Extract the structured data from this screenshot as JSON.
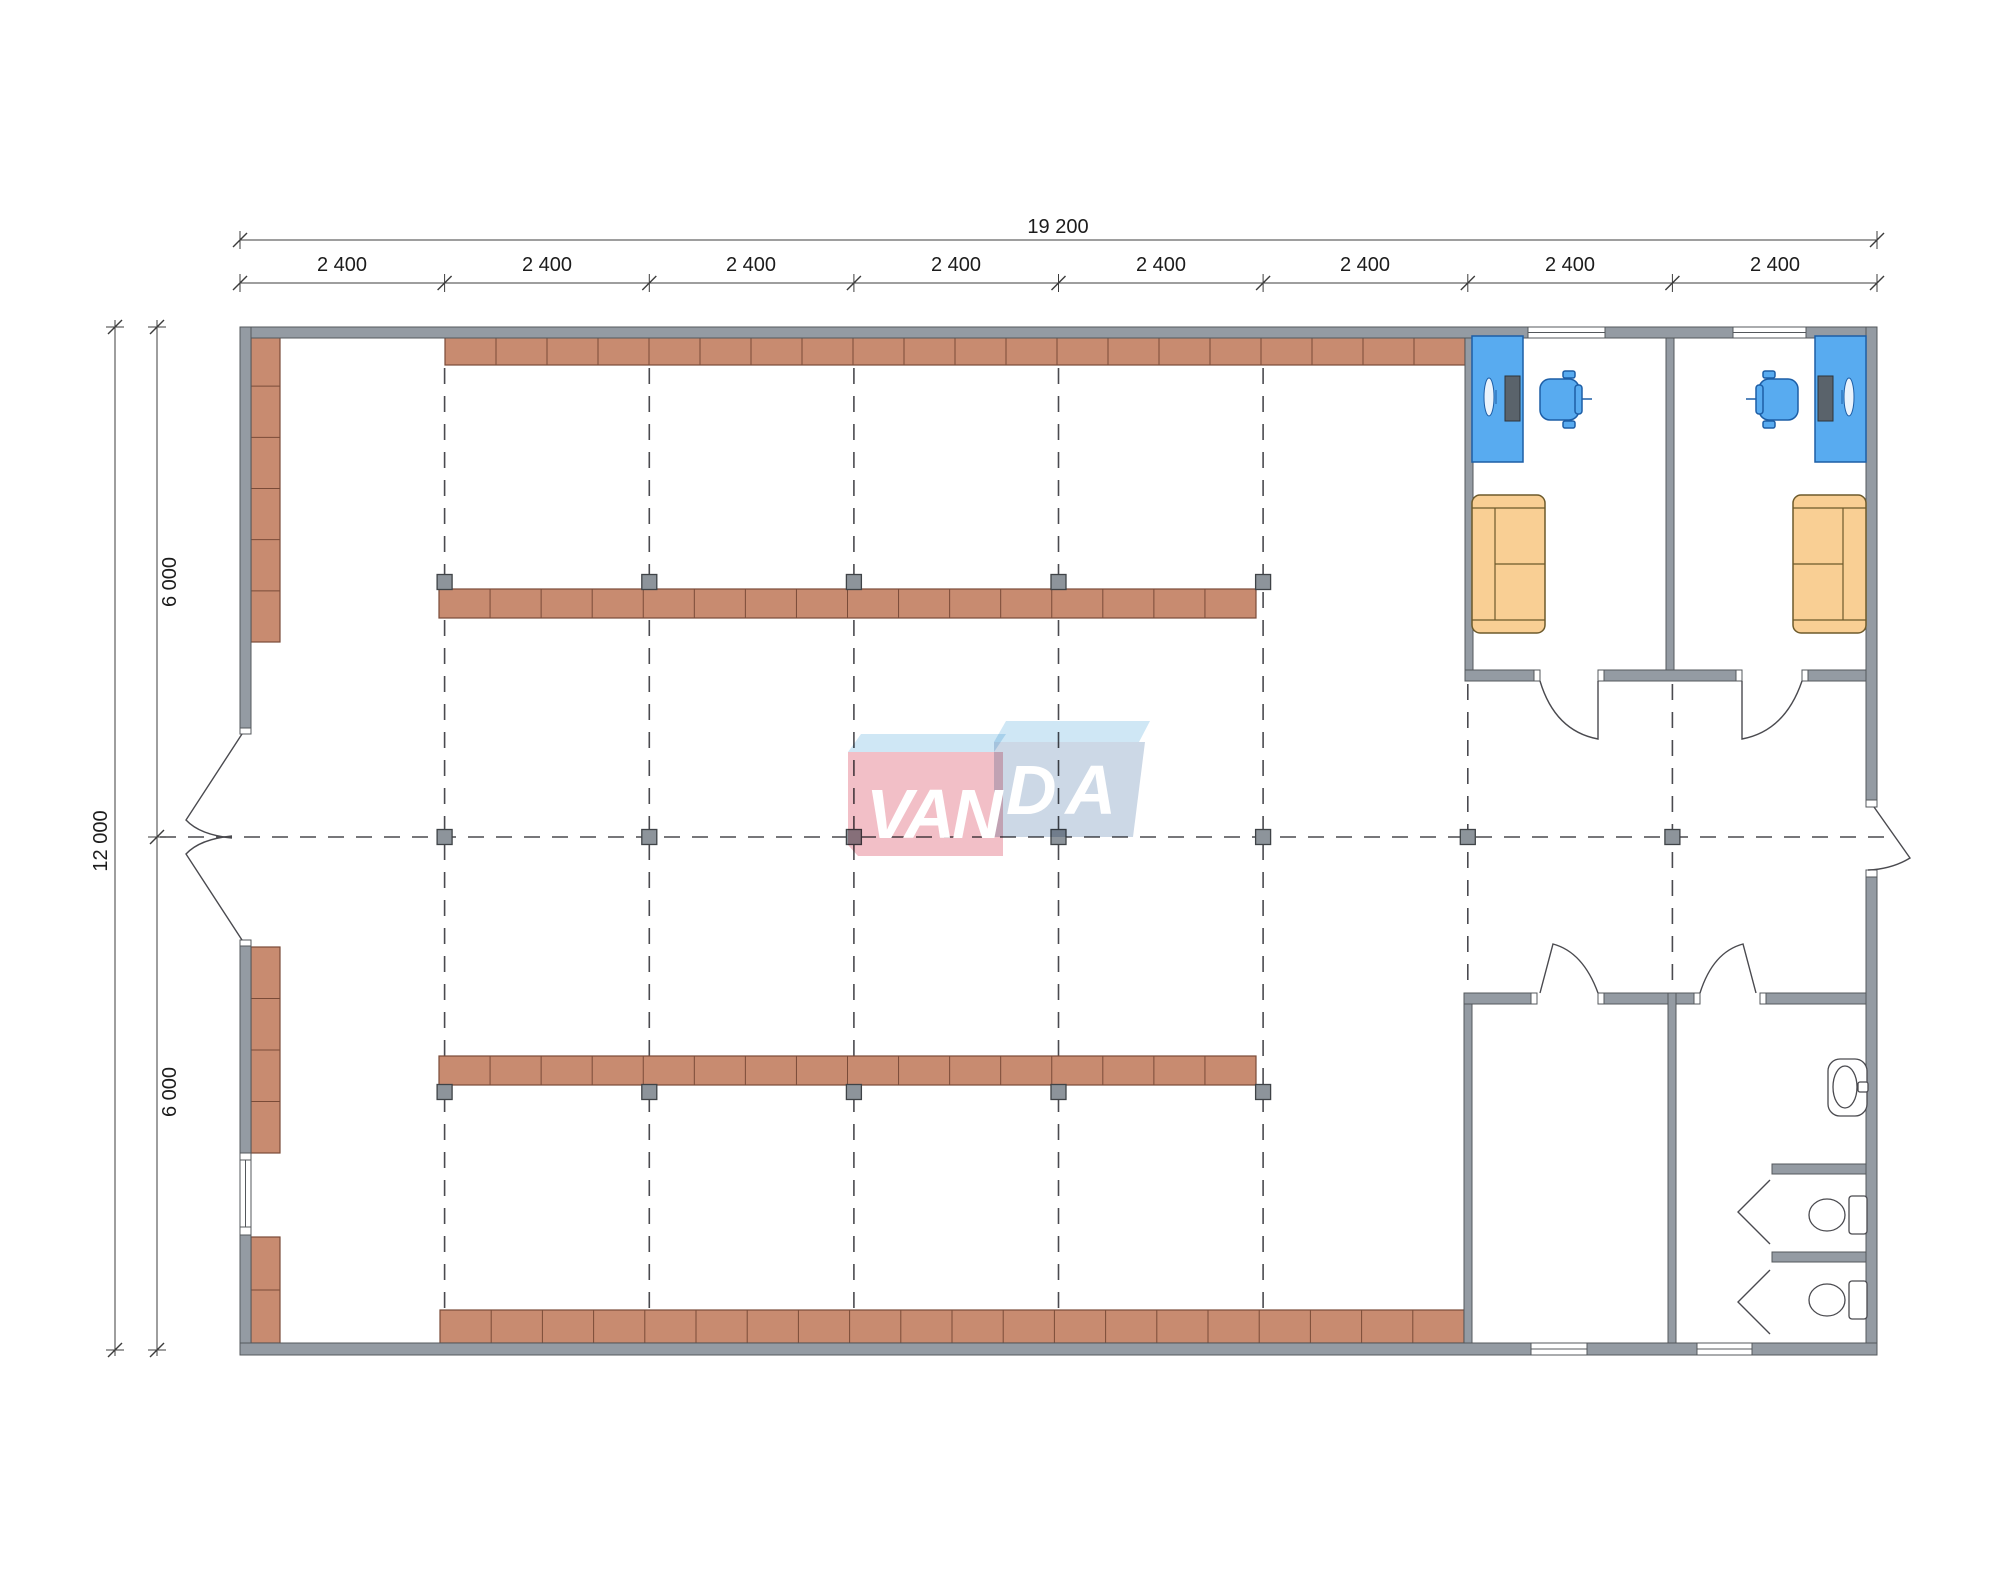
{
  "title": "VANDA modular building floor plan",
  "dimensions": {
    "top_total": "19 200",
    "top_segments": [
      "2 400",
      "2 400",
      "2 400",
      "2 400",
      "2 400",
      "2 400",
      "2 400",
      "2 400"
    ],
    "left_total": "12 000",
    "left_segments": [
      "6 000",
      "6 000"
    ]
  },
  "logo": {
    "part1": "VAN",
    "part2": "DA",
    "pink": "#f2bfc7",
    "blue": "#ccd8e6",
    "flap": "#cfe7f5"
  },
  "colors": {
    "wall_fill": "#949ba3",
    "wall_stroke": "#54585c",
    "shelf_fill": "#c88b70",
    "shelf_stroke": "#7a4b38",
    "column_fill": "#8d949b",
    "column_stroke": "#3f4347",
    "desk_blue": "#58abf0",
    "desk_stroke": "#1d5ea6",
    "sofa_fill": "#f9cf94",
    "sofa_stroke": "#6d5a2b",
    "grid_dash": "#4a4a4f",
    "dim_line": "#3c3c3c",
    "fixture_stroke": "#4a4a4f"
  },
  "plan": {
    "shelves": [
      {
        "x": 445,
        "y": 336,
        "w": 1020,
        "h": 29,
        "seg": 20,
        "dir": "h"
      },
      {
        "x": 439,
        "y": 589,
        "w": 817,
        "h": 29,
        "seg": 16,
        "dir": "h"
      },
      {
        "x": 439,
        "y": 1056,
        "w": 817,
        "h": 29,
        "seg": 16,
        "dir": "h"
      },
      {
        "x": 440,
        "y": 1310,
        "w": 1024,
        "h": 33,
        "seg": 20,
        "dir": "h"
      },
      {
        "x": 251,
        "y": 335,
        "w": 29,
        "h": 307,
        "seg": 6,
        "dir": "v"
      },
      {
        "x": 251,
        "y": 947,
        "w": 29,
        "h": 206,
        "seg": 4,
        "dir": "v"
      },
      {
        "x": 251,
        "y": 1237,
        "w": 29,
        "h": 106,
        "seg": 2,
        "dir": "v"
      }
    ],
    "squares": {
      "size": 15,
      "rows": [
        {
          "cy": 582,
          "xs": [
            444.6,
            649.3,
            853.9,
            1058.5,
            1263.1
          ]
        },
        {
          "cy": 1092,
          "xs": [
            444.6,
            649.3,
            853.9,
            1058.5,
            1263.1
          ]
        },
        {
          "cy": 837,
          "xs": [
            444.6,
            649.3,
            853.9,
            1058.5,
            1263.1,
            1467.8,
            1672.4
          ]
        }
      ]
    },
    "grid": {
      "vertical": [
        {
          "x": 444.6,
          "y1": 368,
          "y2": 1308
        },
        {
          "x": 649.3,
          "y1": 368,
          "y2": 1308
        },
        {
          "x": 853.9,
          "y1": 368,
          "y2": 1308
        },
        {
          "x": 1058.5,
          "y1": 368,
          "y2": 1308
        },
        {
          "x": 1263.1,
          "y1": 368,
          "y2": 1308
        },
        {
          "x": 1467.8,
          "y1": 684,
          "y2": 991
        },
        {
          "x": 1672.4,
          "y1": 684,
          "y2": 991
        }
      ],
      "horizontal": {
        "y": 837,
        "x1": 160,
        "x2": 1895
      }
    },
    "ticks": {
      "top_total": {
        "y": 240,
        "xs": [
          240,
          1877
        ]
      },
      "top_seg": {
        "y": 283,
        "xs": [
          240,
          444.6,
          649.3,
          853.9,
          1058.5,
          1263.1,
          1467.8,
          1672.4,
          1877
        ]
      },
      "left_total": {
        "x": 115,
        "ys": [
          327,
          1350
        ]
      },
      "left_seg": {
        "x": 157,
        "ys": [
          327,
          837,
          1350
        ]
      }
    }
  }
}
